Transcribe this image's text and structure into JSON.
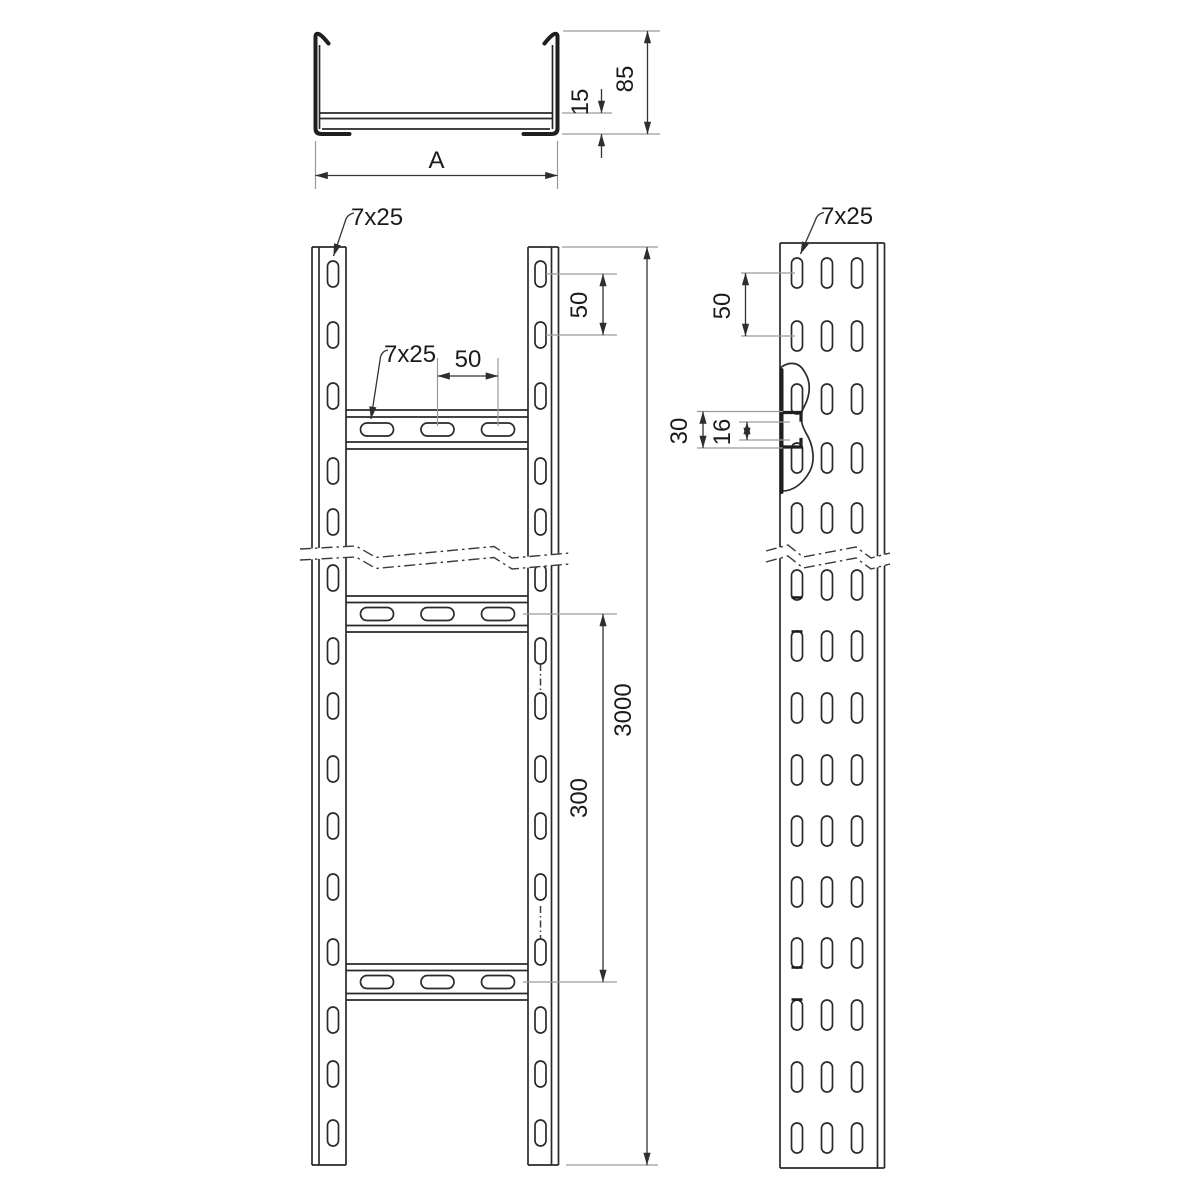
{
  "drawing": {
    "product": "Perforated cable ladder - dimensioned technical drawing",
    "colors": {
      "background": "#ffffff",
      "object_line": "#2a2a2a",
      "thick_profile_line": "#1f1f1f",
      "dimension_line": "#333333",
      "extension_line": "#9a9a9a",
      "text": "#1b1b1b"
    },
    "views": {
      "cross_section": {
        "name": "cross-section",
        "dims": {
          "width": "A",
          "height": "85",
          "bottom_inset": "15"
        }
      },
      "front": {
        "name": "front view",
        "dims": {
          "rail_slot": "7x25",
          "rung_slot": "7x25",
          "rung_slot_spacing": "50",
          "rail_slot_spacing": "50",
          "rung_pitch": "300",
          "total_length": "3000"
        }
      },
      "side": {
        "name": "side view",
        "dims": {
          "slot": "7x25",
          "slot_spacing": "50",
          "rung_depth": "30",
          "rung_opening": "16"
        }
      }
    }
  }
}
